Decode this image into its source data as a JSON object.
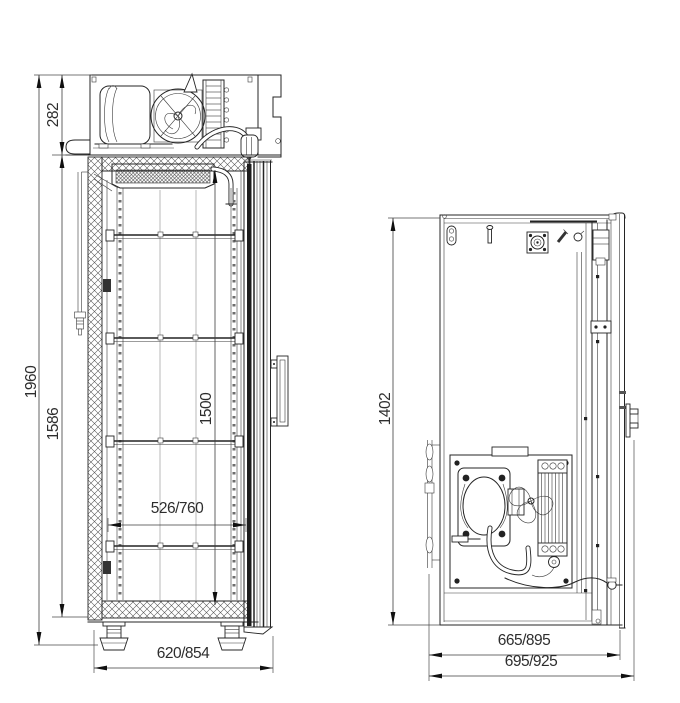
{
  "drawing": {
    "colors": {
      "line": "#242424",
      "background": "#ffffff",
      "gasket": "#1d1d1d"
    },
    "views": {
      "front": {
        "dims": {
          "overall_height": "1960",
          "machine_compartment_height": "282",
          "body_height": "1586",
          "interior_height": "1500",
          "interior_width": "526/760",
          "overall_width": "620/854"
        }
      },
      "side": {
        "dims": {
          "body_height": "1402",
          "depth_without_handle": "665/895",
          "overall_depth": "695/925"
        }
      }
    }
  }
}
